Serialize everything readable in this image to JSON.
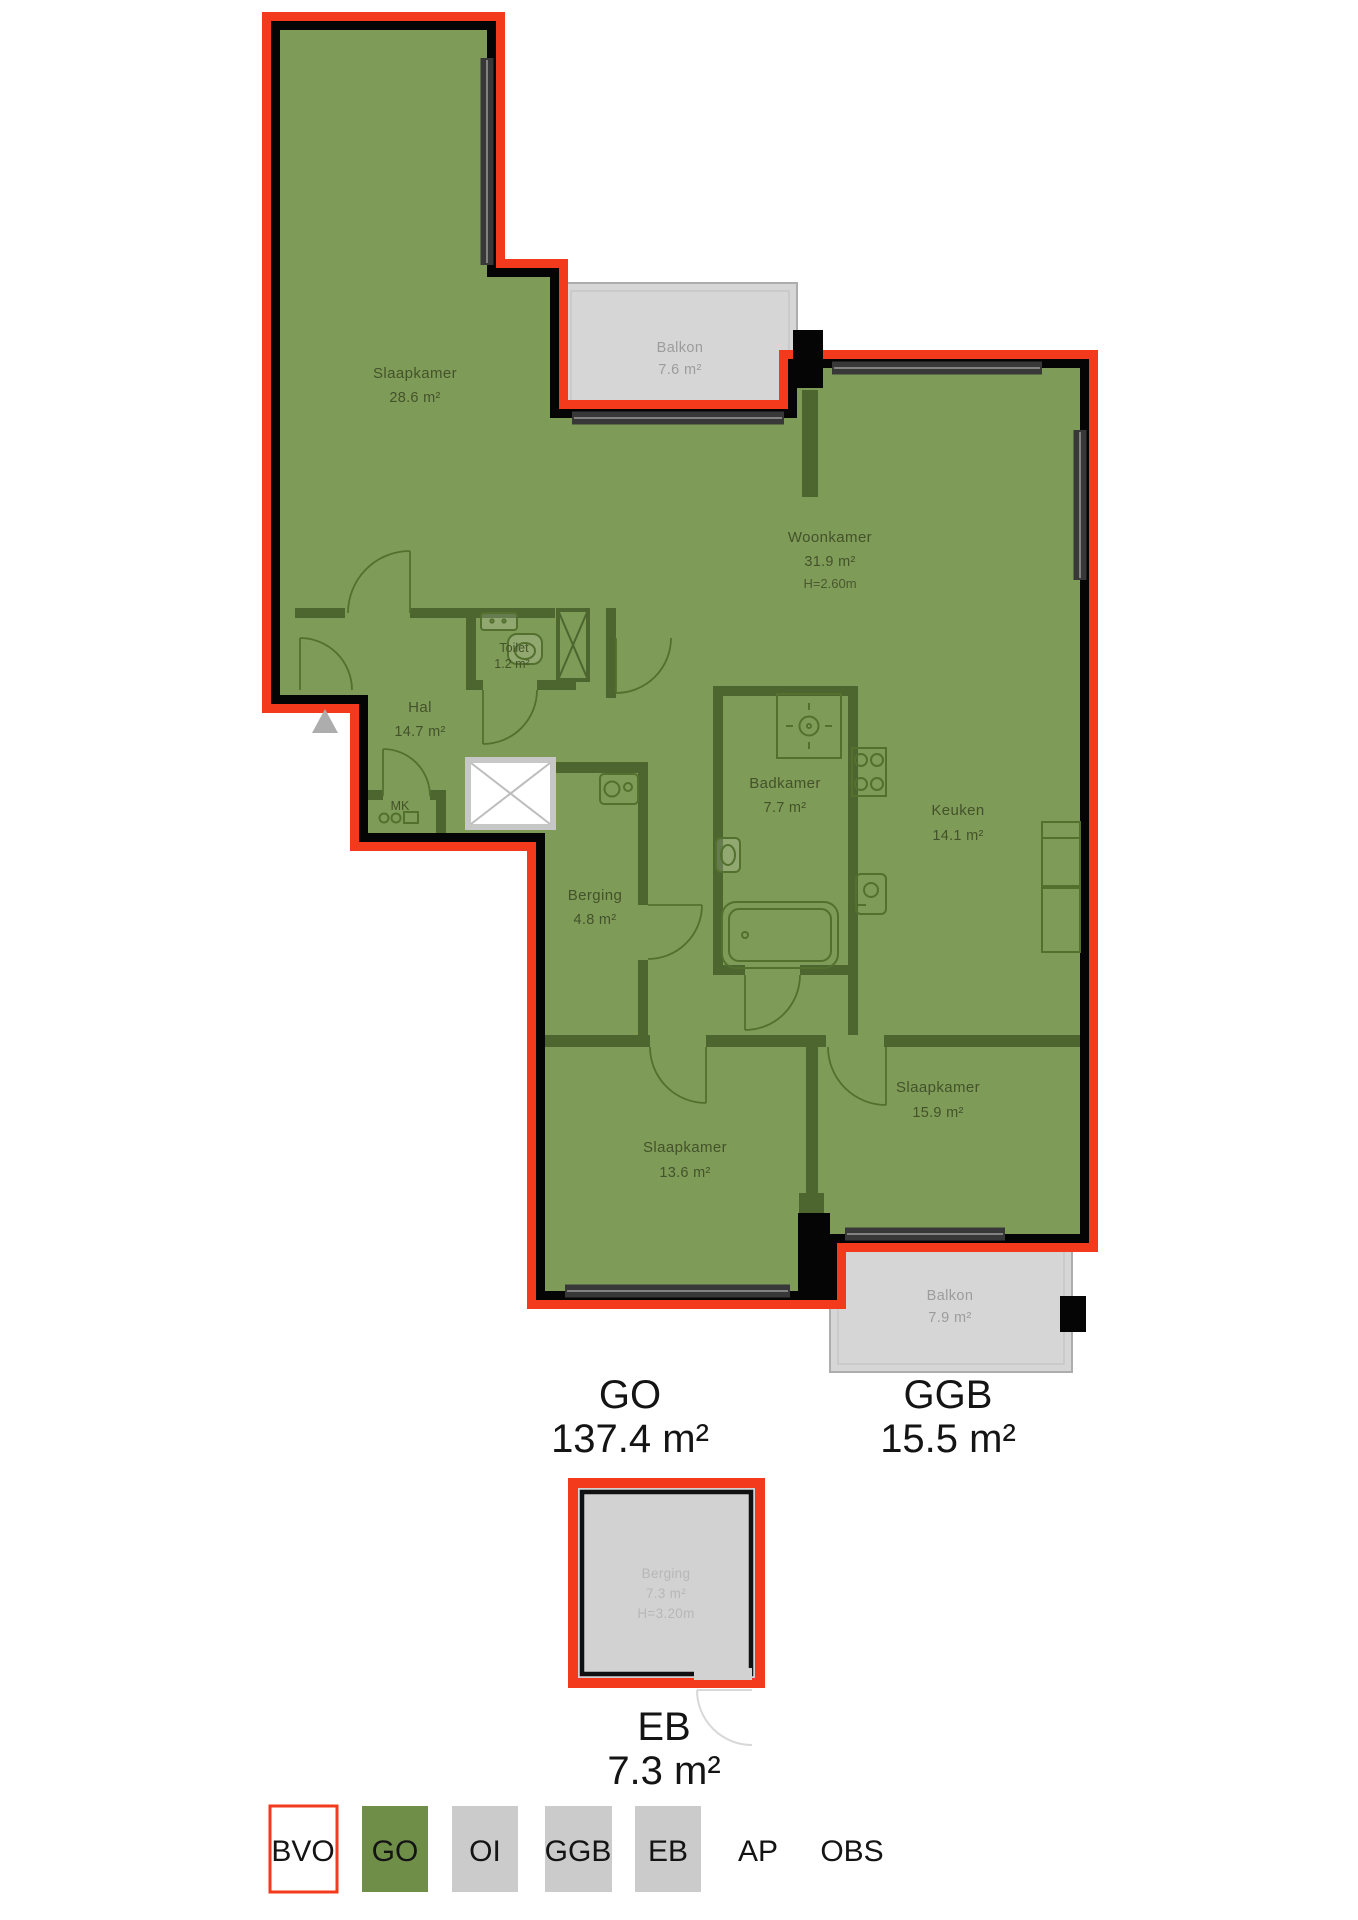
{
  "colors": {
    "bvo_red": "#F43A1D",
    "room_green": "#7E9B57",
    "legend_green": "#6F8F49",
    "wall_green": "#4D6630",
    "wall_black": "#050505",
    "balcony_gray": "#D6D6D6",
    "legend_gray": "#CBCBCB"
  },
  "rooms": {
    "slaapkamer1": {
      "name": "Slaapkamer",
      "area": "28.6 m²"
    },
    "balkon1": {
      "name": "Balkon",
      "area": "7.6 m²"
    },
    "woonkamer": {
      "name": "Woonkamer",
      "area": "31.9 m²",
      "height": "H=2.60m"
    },
    "toilet": {
      "name": "Toilet",
      "area": "1.2 m²"
    },
    "hal": {
      "name": "Hal",
      "area": "14.7 m²"
    },
    "mk": {
      "name": "MK"
    },
    "badkamer": {
      "name": "Badkamer",
      "area": "7.7 m²"
    },
    "keuken": {
      "name": "Keuken",
      "area": "14.1 m²"
    },
    "berging": {
      "name": "Berging",
      "area": "4.8 m²"
    },
    "slaapkamer2": {
      "name": "Slaapkamer",
      "area": "15.9 m²"
    },
    "slaapkamer3": {
      "name": "Slaapkamer",
      "area": "13.6 m²"
    },
    "balkon2": {
      "name": "Balkon",
      "area": "7.9 m²"
    },
    "externe_berging": {
      "name": "Berging",
      "area": "7.3 m²",
      "height": "H=3.20m"
    }
  },
  "summaries": {
    "go": {
      "label": "GO",
      "value": "137.4 m²"
    },
    "ggb": {
      "label": "GGB",
      "value": "15.5 m²"
    },
    "eb": {
      "label": "EB",
      "value": "7.3 m²"
    }
  },
  "legend": {
    "items": [
      {
        "label": "BVO",
        "style": "outline-red"
      },
      {
        "label": "GO",
        "style": "green"
      },
      {
        "label": "OI",
        "style": "gray"
      },
      {
        "label": "GGB",
        "style": "gray"
      },
      {
        "label": "EB",
        "style": "gray"
      },
      {
        "label": "AP",
        "style": "text"
      },
      {
        "label": "OBS",
        "style": "text"
      }
    ]
  }
}
